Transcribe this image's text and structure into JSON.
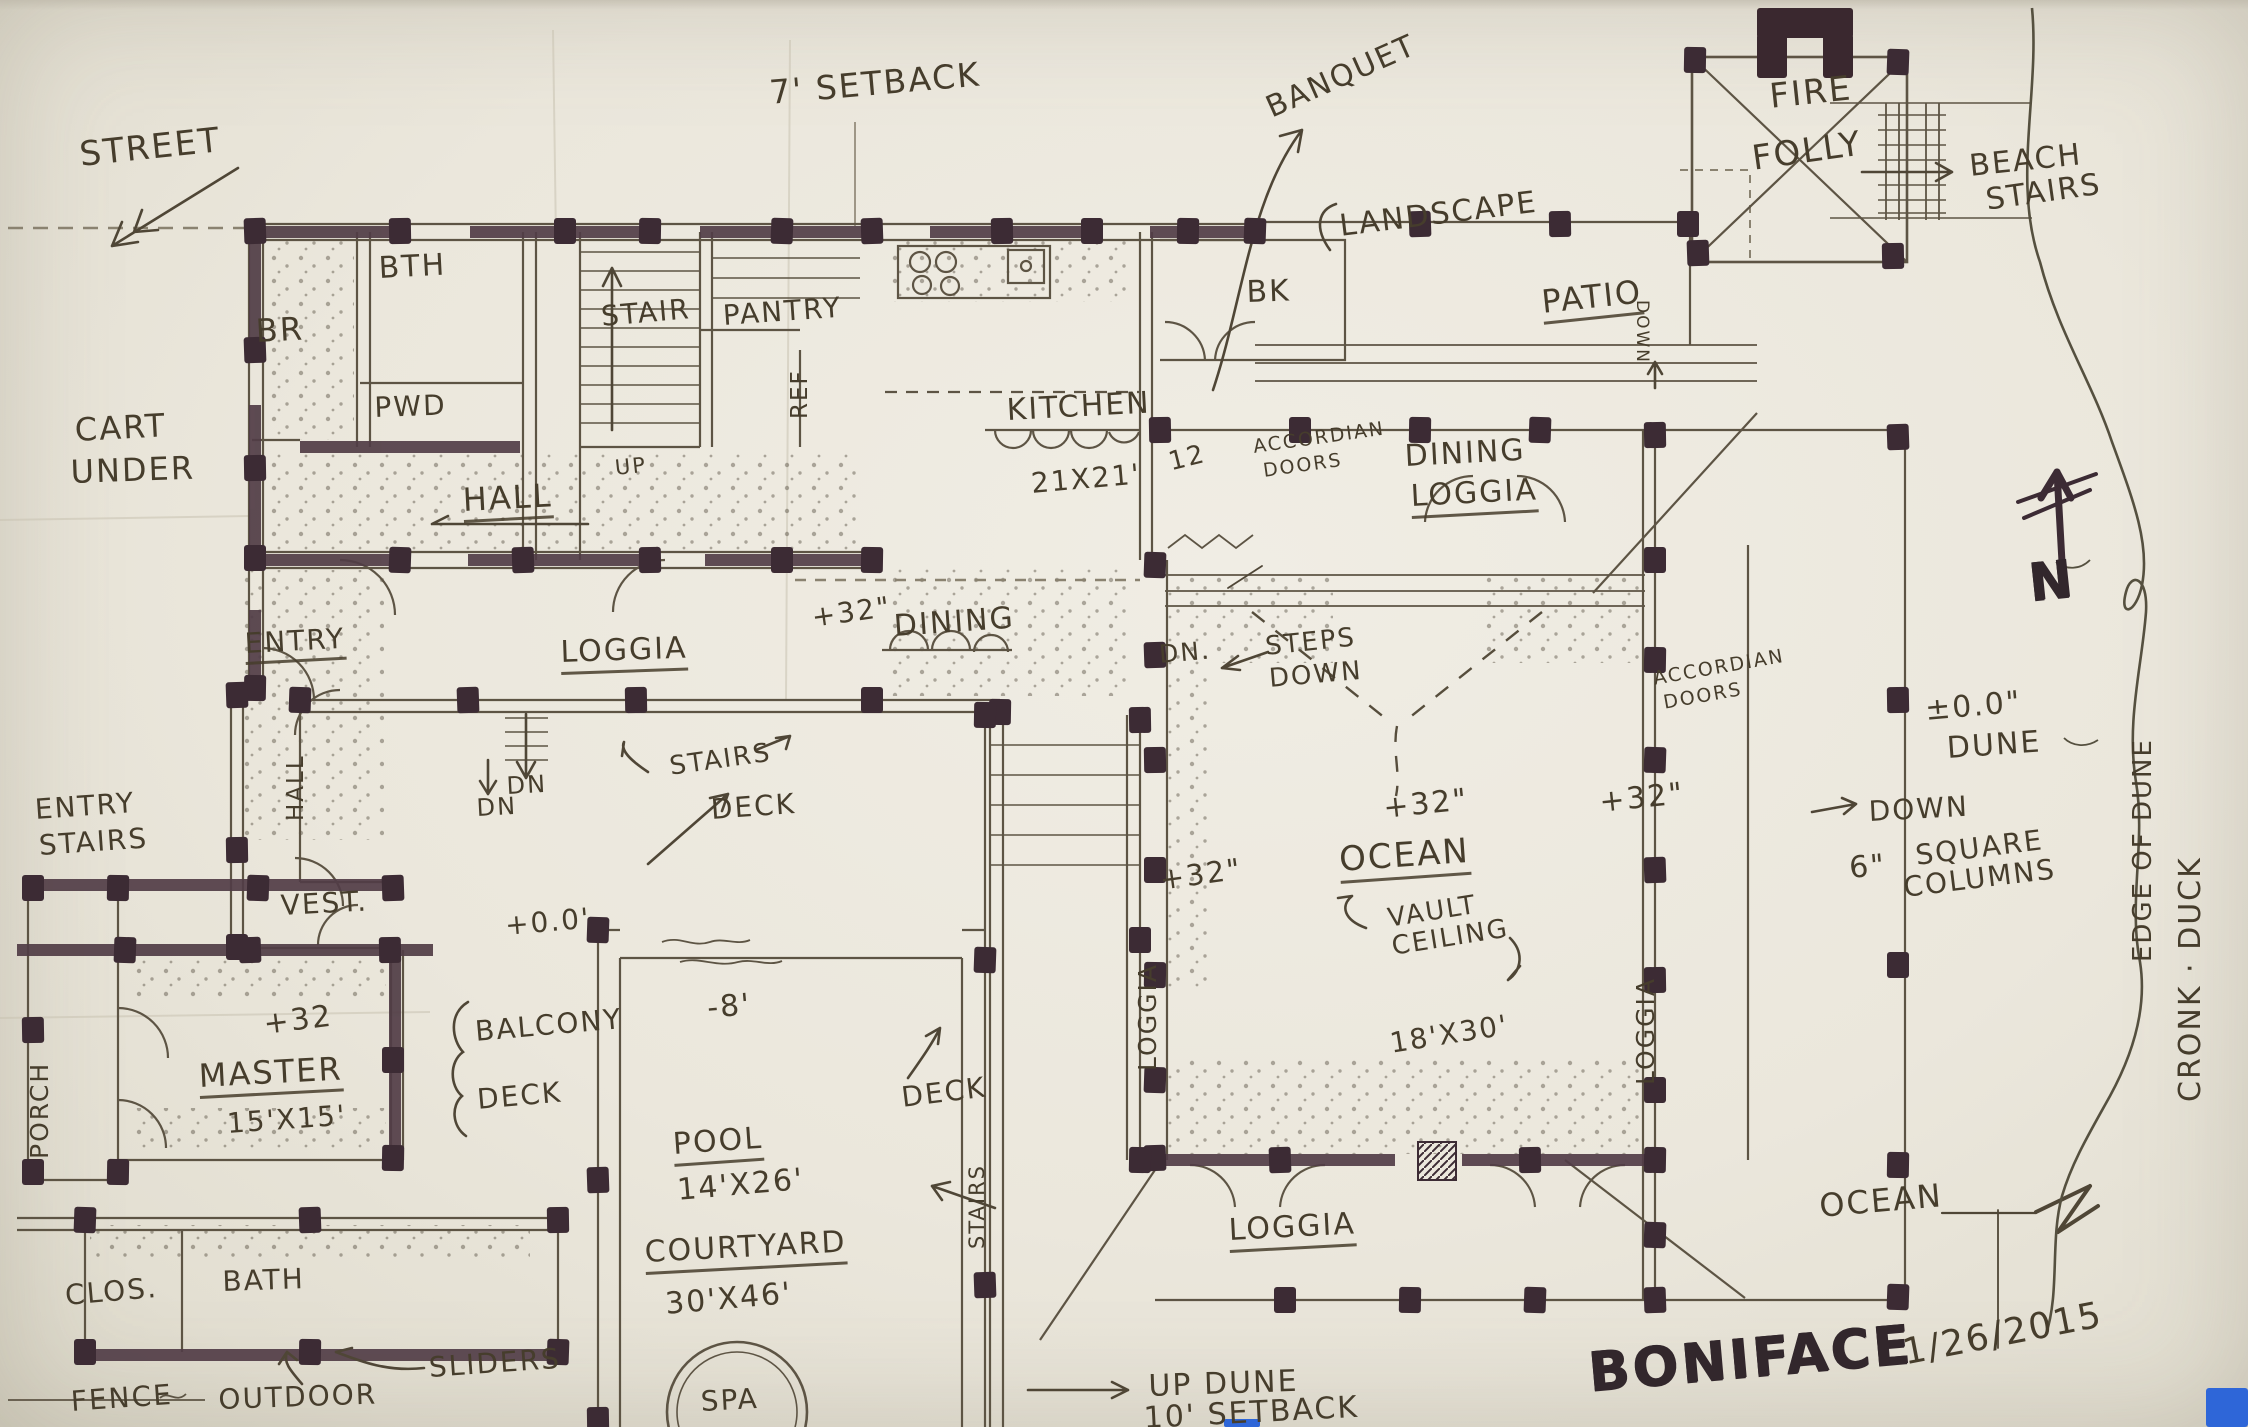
{
  "sheet": {
    "kind": "hand-drawn architectural floor plan sketch",
    "project": "BONIFACE",
    "date": "1/26/2015"
  },
  "palette": {
    "paper": "#ebe7dc",
    "pen_ink": "#5d5444",
    "wall_marker": "#513d46",
    "post_marker": "#3c2b34",
    "lettering": "#463d2c",
    "blue_tab": "#2e66d8"
  },
  "annotations": [
    {
      "id": "street",
      "text": "STREET",
      "x": 78,
      "y": 138,
      "s": 34,
      "r": -6
    },
    {
      "id": "setback-7",
      "text": "7' SETBACK",
      "x": 768,
      "y": 76,
      "s": 33,
      "r": -5
    },
    {
      "id": "banquet",
      "text": "BANQUET",
      "x": 1262,
      "y": 96,
      "s": 30,
      "r": -24
    },
    {
      "id": "fire",
      "text": "FIRE",
      "x": 1768,
      "y": 80,
      "s": 34,
      "r": -6
    },
    {
      "id": "folly",
      "text": "FOLLY",
      "x": 1750,
      "y": 142,
      "s": 34,
      "r": -8
    },
    {
      "id": "beach",
      "text": "BEACH",
      "x": 1968,
      "y": 152,
      "s": 30,
      "r": -6
    },
    {
      "id": "beach-stairs",
      "text": "STAIRS",
      "x": 1984,
      "y": 186,
      "s": 30,
      "r": -8
    },
    {
      "id": "landscape",
      "text": "LANDSCAPE",
      "x": 1338,
      "y": 212,
      "s": 30,
      "r": -7
    },
    {
      "id": "patio",
      "text": "PATIO",
      "x": 1540,
      "y": 286,
      "s": 32,
      "r": -6,
      "u": true
    },
    {
      "id": "patio-down",
      "text": "DOWN",
      "x": 1650,
      "y": 300,
      "s": 17,
      "r": 90,
      "v": "dn"
    },
    {
      "id": "bk",
      "text": "BK",
      "x": 1246,
      "y": 278,
      "s": 30,
      "r": -2
    },
    {
      "id": "br",
      "text": "BR",
      "x": 255,
      "y": 315,
      "s": 32,
      "r": -3
    },
    {
      "id": "bth",
      "text": "BTH",
      "x": 378,
      "y": 254,
      "s": 30,
      "r": -3
    },
    {
      "id": "stair",
      "text": "STAIR",
      "x": 600,
      "y": 303,
      "s": 28,
      "r": -5
    },
    {
      "id": "pantry",
      "text": "PANTRY",
      "x": 722,
      "y": 302,
      "s": 28,
      "r": -4
    },
    {
      "id": "pwd",
      "text": "PWD",
      "x": 374,
      "y": 394,
      "s": 28,
      "r": -2
    },
    {
      "id": "ref",
      "text": "REF",
      "x": 812,
      "y": 396,
      "s": 23,
      "r": -90,
      "v": "up"
    },
    {
      "id": "kitchen",
      "text": "KITCHEN",
      "x": 1006,
      "y": 396,
      "s": 30,
      "r": -3
    },
    {
      "id": "kitchen-size",
      "text": "21X21'",
      "x": 1030,
      "y": 470,
      "s": 28,
      "r": -5
    },
    {
      "id": "kitchen-note",
      "text": "12",
      "x": 1166,
      "y": 450,
      "s": 26,
      "r": -14
    },
    {
      "id": "cart-1",
      "text": "CART",
      "x": 74,
      "y": 414,
      "s": 32,
      "r": -3
    },
    {
      "id": "cart-2",
      "text": "UNDER",
      "x": 70,
      "y": 456,
      "s": 32,
      "r": -2
    },
    {
      "id": "hall",
      "text": "HALL",
      "x": 462,
      "y": 484,
      "s": 32,
      "r": -3,
      "u": true
    },
    {
      "id": "up-hall",
      "text": "UP",
      "x": 614,
      "y": 458,
      "s": 21,
      "r": -6
    },
    {
      "id": "accordian-w-1",
      "text": "ACCORDIAN",
      "x": 1252,
      "y": 438,
      "s": 19,
      "r": -8
    },
    {
      "id": "accordian-w-2",
      "text": "DOORS",
      "x": 1262,
      "y": 462,
      "s": 19,
      "r": -8
    },
    {
      "id": "dining-loggia-1",
      "text": "DINING",
      "x": 1404,
      "y": 442,
      "s": 30,
      "r": -3
    },
    {
      "id": "dining-loggia-2",
      "text": "LOGGIA",
      "x": 1410,
      "y": 482,
      "s": 30,
      "r": -3,
      "u": true
    },
    {
      "id": "dining",
      "text": "DINING",
      "x": 893,
      "y": 612,
      "s": 30,
      "r": -4
    },
    {
      "id": "dn-steps",
      "text": "DN.",
      "x": 1158,
      "y": 642,
      "s": 25,
      "r": -5
    },
    {
      "id": "steps-1",
      "text": "STEPS",
      "x": 1264,
      "y": 634,
      "s": 26,
      "r": -6
    },
    {
      "id": "steps-2",
      "text": "DOWN",
      "x": 1268,
      "y": 666,
      "s": 26,
      "r": -5
    },
    {
      "id": "accordian-e-1",
      "text": "ACCORDIAN",
      "x": 1652,
      "y": 670,
      "s": 19,
      "r": -10
    },
    {
      "id": "accordian-e-2",
      "text": "DOORS",
      "x": 1662,
      "y": 694,
      "s": 19,
      "r": -10
    },
    {
      "id": "plus32-deck",
      "text": "+32\"",
      "x": 810,
      "y": 604,
      "s": 28,
      "r": -8
    },
    {
      "id": "plus32-west",
      "text": "+32\"",
      "x": 1158,
      "y": 866,
      "s": 29,
      "r": -8
    },
    {
      "id": "plus32-center",
      "text": "+32\"",
      "x": 1382,
      "y": 794,
      "s": 30,
      "r": -6
    },
    {
      "id": "plus32-east",
      "text": "+32\"",
      "x": 1598,
      "y": 788,
      "s": 30,
      "r": -6
    },
    {
      "id": "ocean-room",
      "text": "OCEAN",
      "x": 1338,
      "y": 843,
      "s": 34,
      "r": -4,
      "u": true
    },
    {
      "id": "vault-1",
      "text": "VAULT",
      "x": 1386,
      "y": 906,
      "s": 26,
      "r": -9
    },
    {
      "id": "vault-2",
      "text": "CEILING",
      "x": 1390,
      "y": 934,
      "s": 26,
      "r": -9
    },
    {
      "id": "size-18x30",
      "text": "18'X30'",
      "x": 1388,
      "y": 1030,
      "s": 28,
      "r": -9
    },
    {
      "id": "loggia-w-vert",
      "text": "LOGGIA",
      "x": 1160,
      "y": 1046,
      "s": 25,
      "r": -90,
      "v": "up"
    },
    {
      "id": "loggia-e-vert",
      "text": "LOGGIA",
      "x": 1658,
      "y": 1060,
      "s": 25,
      "r": -90,
      "v": "up"
    },
    {
      "id": "entry",
      "text": "ENTRY",
      "x": 244,
      "y": 630,
      "s": 28,
      "r": -3,
      "u": true
    },
    {
      "id": "loggia-west",
      "text": "LOGGIA",
      "x": 560,
      "y": 638,
      "s": 30,
      "r": -2,
      "u": true
    },
    {
      "id": "stairs-mid",
      "text": "STAIRS",
      "x": 668,
      "y": 754,
      "s": 26,
      "r": -8
    },
    {
      "id": "deck-mid",
      "text": "DECK",
      "x": 710,
      "y": 796,
      "s": 28,
      "r": -4
    },
    {
      "id": "dn-loggia",
      "text": "DN",
      "x": 506,
      "y": 774,
      "s": 24,
      "r": -3
    },
    {
      "id": "hall-vert",
      "text": "HALL",
      "x": 308,
      "y": 798,
      "s": 23,
      "r": -90,
      "v": "up"
    },
    {
      "id": "entry-stairs-1",
      "text": "ENTRY",
      "x": 34,
      "y": 796,
      "s": 28,
      "r": -4
    },
    {
      "id": "entry-stairs-2",
      "text": "STAIRS",
      "x": 38,
      "y": 832,
      "s": 28,
      "r": -4
    },
    {
      "id": "vest",
      "text": "VEST.",
      "x": 280,
      "y": 892,
      "s": 28,
      "r": -3
    },
    {
      "id": "dn-vest",
      "text": "DN",
      "x": 476,
      "y": 796,
      "s": 24,
      "r": -3
    },
    {
      "id": "plus00-deck",
      "text": "+0.0'",
      "x": 504,
      "y": 912,
      "s": 28,
      "r": -5
    },
    {
      "id": "minus-8",
      "text": "-8'",
      "x": 706,
      "y": 994,
      "s": 30,
      "r": -5
    },
    {
      "id": "porch-vert",
      "text": "PORCH",
      "x": 52,
      "y": 1134,
      "s": 25,
      "r": -90,
      "v": "up"
    },
    {
      "id": "plus32-master",
      "text": "+32",
      "x": 262,
      "y": 1010,
      "s": 30,
      "r": -7
    },
    {
      "id": "master",
      "text": "MASTER",
      "x": 198,
      "y": 1060,
      "s": 32,
      "r": -3,
      "u": true
    },
    {
      "id": "master-size",
      "text": "15'X15'",
      "x": 226,
      "y": 1110,
      "s": 28,
      "r": -4
    },
    {
      "id": "balcony",
      "text": "BALCONY",
      "x": 474,
      "y": 1018,
      "s": 28,
      "r": -5
    },
    {
      "id": "deck-balcony",
      "text": "DECK",
      "x": 476,
      "y": 1086,
      "s": 28,
      "r": -5
    },
    {
      "id": "clos",
      "text": "CLOS.",
      "x": 64,
      "y": 1282,
      "s": 28,
      "r": -5
    },
    {
      "id": "bath",
      "text": "BATH",
      "x": 222,
      "y": 1268,
      "s": 28,
      "r": -2
    },
    {
      "id": "fence",
      "text": "FENCE",
      "x": 70,
      "y": 1388,
      "s": 28,
      "r": -4
    },
    {
      "id": "outdoor",
      "text": "OUTDOOR",
      "x": 218,
      "y": 1386,
      "s": 28,
      "r": -2
    },
    {
      "id": "sliders",
      "text": "SLIDERS",
      "x": 428,
      "y": 1354,
      "s": 28,
      "r": -4
    },
    {
      "id": "pool",
      "text": "POOL",
      "x": 672,
      "y": 1130,
      "s": 30,
      "r": -4,
      "u": true
    },
    {
      "id": "pool-size",
      "text": "14'X26'",
      "x": 676,
      "y": 1176,
      "s": 30,
      "r": -5
    },
    {
      "id": "courtyard",
      "text": "COURTYARD",
      "x": 644,
      "y": 1238,
      "s": 30,
      "r": -3,
      "u": true
    },
    {
      "id": "courtyard-size",
      "text": "30'X46'",
      "x": 664,
      "y": 1290,
      "s": 30,
      "r": -5
    },
    {
      "id": "spa",
      "text": "SPA",
      "x": 700,
      "y": 1388,
      "s": 28,
      "r": -3
    },
    {
      "id": "deck-pool-e",
      "text": "DECK",
      "x": 900,
      "y": 1084,
      "s": 28,
      "r": -7
    },
    {
      "id": "stairs-e-vert",
      "text": "STAIRS",
      "x": 988,
      "y": 1228,
      "s": 21,
      "r": -90,
      "v": "up"
    },
    {
      "id": "up-dune-1",
      "text": "UP DUNE",
      "x": 1148,
      "y": 1372,
      "s": 30,
      "r": -2
    },
    {
      "id": "up-dune-2",
      "text": "10' SETBACK",
      "x": 1143,
      "y": 1404,
      "s": 30,
      "r": -3
    },
    {
      "id": "loggia-south",
      "text": "LOGGIA",
      "x": 1228,
      "y": 1216,
      "s": 30,
      "r": -3,
      "u": true
    },
    {
      "id": "ocean-sea",
      "text": "OCEAN",
      "x": 1818,
      "y": 1190,
      "s": 32,
      "r": -5
    },
    {
      "id": "boniface",
      "text": "BONIFACE",
      "x": 1586,
      "y": 1346,
      "s": 54,
      "r": -5,
      "m": true
    },
    {
      "id": "sheet-date",
      "text": "1/26/2015",
      "x": 1900,
      "y": 1336,
      "s": 36,
      "r": -11
    },
    {
      "id": "dune-elev",
      "text": "±0.0\"",
      "x": 1924,
      "y": 696,
      "s": 30,
      "r": -5
    },
    {
      "id": "dune",
      "text": "DUNE",
      "x": 1946,
      "y": 734,
      "s": 30,
      "r": -4
    },
    {
      "id": "down-east",
      "text": "DOWN",
      "x": 1868,
      "y": 798,
      "s": 28,
      "r": -3
    },
    {
      "id": "six-inch",
      "text": "6\"",
      "x": 1848,
      "y": 854,
      "s": 30,
      "r": -5
    },
    {
      "id": "square",
      "text": "SQUARE",
      "x": 1914,
      "y": 842,
      "s": 28,
      "r": -7
    },
    {
      "id": "columns",
      "text": "COLUMNS",
      "x": 1902,
      "y": 874,
      "s": 28,
      "r": -7
    },
    {
      "id": "north-letter",
      "text": "N",
      "x": 2026,
      "y": 558,
      "s": 52,
      "r": -6,
      "m": true
    },
    {
      "id": "edge-of-dune-vert",
      "text": "EDGE OF DUNE",
      "x": 2156,
      "y": 936,
      "s": 26,
      "r": -90,
      "v": "up"
    },
    {
      "id": "cronk-duck-vert",
      "text": "CRONK · DUCK",
      "x": 2206,
      "y": 1072,
      "s": 30,
      "r": -90,
      "v": "up"
    }
  ]
}
